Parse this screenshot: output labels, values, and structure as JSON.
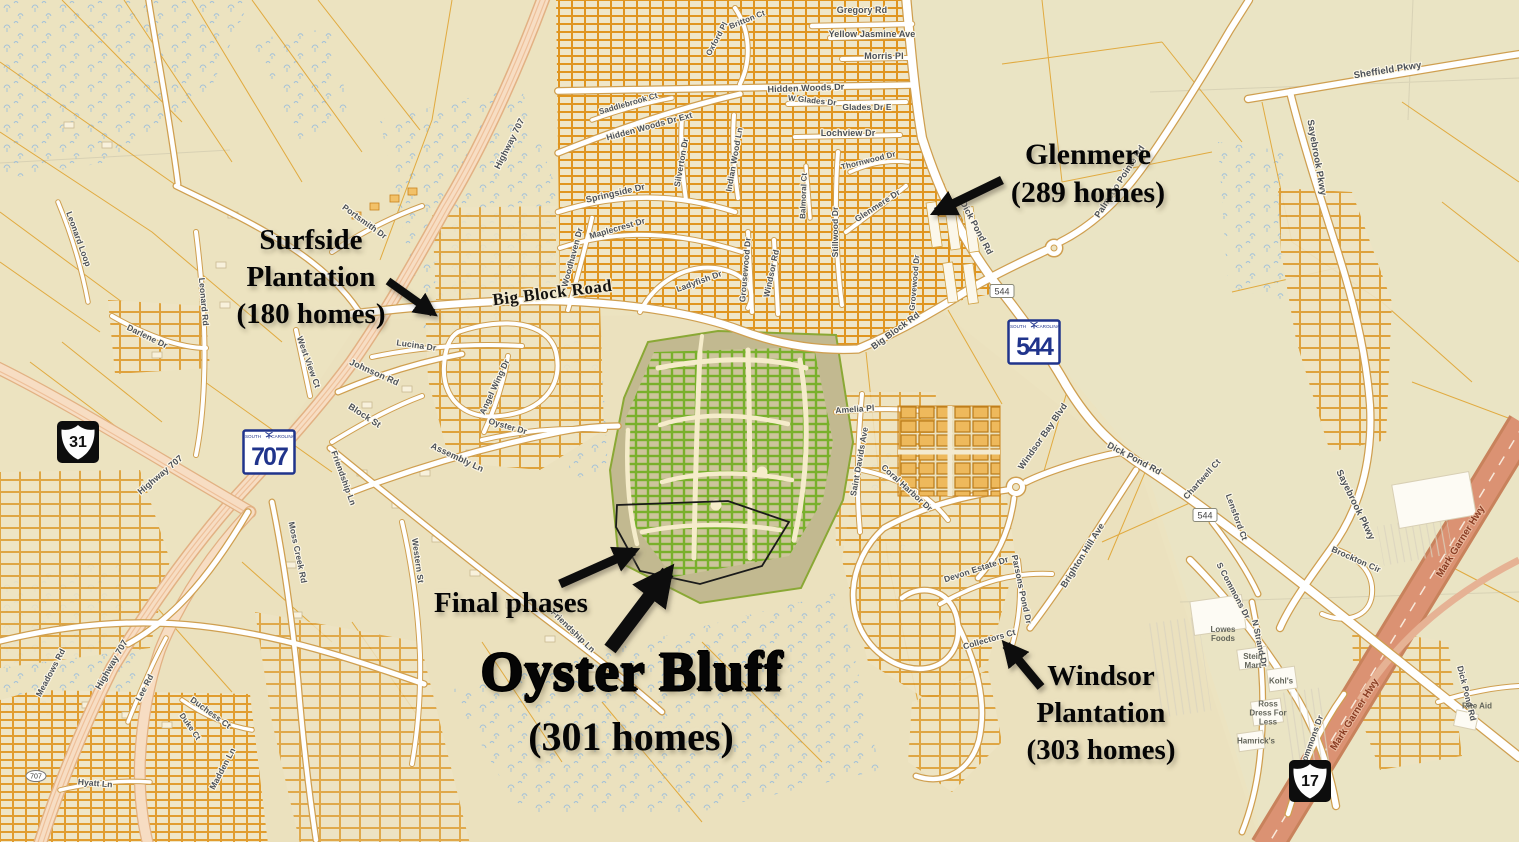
{
  "map_title": "Oyster Bluff area annotated map",
  "annotations": [
    {
      "id": "surfside-plantation",
      "lines": [
        "Surfside",
        "Plantation",
        "(180 homes)"
      ],
      "x": 311,
      "y": 222,
      "size": 29,
      "line_height": 37
    },
    {
      "id": "glenmere",
      "lines": [
        "Glenmere",
        "(289 homes)"
      ],
      "x": 1088,
      "y": 136,
      "size": 30,
      "line_height": 38
    },
    {
      "id": "final-phases",
      "lines": [
        "Final phases"
      ],
      "x": 511,
      "y": 586,
      "size": 29,
      "line_height": 34
    },
    {
      "id": "oyster-bluff",
      "lines": [
        "Oyster Bluff"
      ],
      "x": 632,
      "y": 641,
      "size": 55,
      "line_height": 62,
      "heavy": true
    },
    {
      "id": "oyster-bluff-homes",
      "lines": [
        "(301 homes)"
      ],
      "x": 631,
      "y": 714,
      "size": 40,
      "line_height": 46
    },
    {
      "id": "windsor-plantation",
      "lines": [
        "Windsor",
        "Plantation",
        "(303 homes)"
      ],
      "x": 1101,
      "y": 658,
      "size": 29,
      "line_height": 37
    }
  ],
  "arrows": [
    {
      "x1": 388,
      "y1": 281,
      "x2": 433,
      "y2": 313,
      "w": 8
    },
    {
      "x1": 1002,
      "y1": 180,
      "x2": 936,
      "y2": 212,
      "w": 9
    },
    {
      "x1": 560,
      "y1": 584,
      "x2": 634,
      "y2": 551,
      "w": 9
    },
    {
      "x1": 610,
      "y1": 649,
      "x2": 668,
      "y2": 572,
      "w": 14
    },
    {
      "x1": 1041,
      "y1": 687,
      "x2": 1006,
      "y2": 645,
      "w": 9
    }
  ],
  "shield_header": {
    "left": "SOUTH",
    "right": "CAROLINA"
  },
  "highway_shields": [
    {
      "type": "us",
      "label": "31",
      "x": 78,
      "y": 442
    },
    {
      "type": "sc",
      "label": "707",
      "x": 269,
      "y": 452
    },
    {
      "type": "sc",
      "label": "544",
      "x": 1034,
      "y": 342
    },
    {
      "type": "us",
      "label": "17",
      "x": 1310,
      "y": 781
    },
    {
      "type": "mini",
      "label": "544",
      "x": 1002,
      "y": 291
    },
    {
      "type": "mini",
      "label": "544",
      "x": 1205,
      "y": 515
    },
    {
      "type": "oval",
      "label": "707",
      "x": 36,
      "y": 776
    }
  ],
  "place_labels": [
    {
      "t": "Lowes\nFoods",
      "x": 1223,
      "y": 634
    },
    {
      "t": "Stein\nMart",
      "x": 1253,
      "y": 661
    },
    {
      "t": "Kohl's",
      "x": 1281,
      "y": 681
    },
    {
      "t": "Ross\nDress For\nLess",
      "x": 1268,
      "y": 713
    },
    {
      "t": "Hamrick's",
      "x": 1256,
      "y": 741
    },
    {
      "t": "Rite Aid",
      "x": 1477,
      "y": 706
    }
  ],
  "road_labels": [
    {
      "t": "Gregory Rd",
      "x": 862,
      "y": 13,
      "r": 0
    },
    {
      "t": "Yellow Jasmine Ave",
      "x": 872,
      "y": 37,
      "r": 0
    },
    {
      "t": "Morris Pl",
      "x": 884,
      "y": 59,
      "r": 0
    },
    {
      "t": "Hidden Woods Dr",
      "x": 806,
      "y": 91,
      "r": -2
    },
    {
      "t": "W Glades Dr",
      "x": 812,
      "y": 103,
      "r": 6,
      "s": 8
    },
    {
      "t": "Glades Dr E",
      "x": 867,
      "y": 110,
      "r": 0,
      "s": 8.5
    },
    {
      "t": "Lochview Dr",
      "x": 848,
      "y": 136,
      "r": 0
    },
    {
      "t": "Saddlebrook Ct",
      "x": 629,
      "y": 106,
      "r": -16,
      "s": 8
    },
    {
      "t": "Hidden Woods Dr Ext",
      "x": 650,
      "y": 129,
      "r": -15,
      "s": 8.5
    },
    {
      "t": "Oxford Pl",
      "x": 719,
      "y": 40,
      "r": -62,
      "s": 8
    },
    {
      "t": "Britton Ct",
      "x": 748,
      "y": 22,
      "r": -22,
      "s": 8
    },
    {
      "t": "Springside Dr",
      "x": 616,
      "y": 196,
      "r": -13
    },
    {
      "t": "Maplecrest Dr",
      "x": 618,
      "y": 231,
      "r": -16,
      "s": 8.5
    },
    {
      "t": "Woodhaven Dr",
      "x": 575,
      "y": 258,
      "r": -75,
      "s": 8.5
    },
    {
      "t": "Silverton Dr",
      "x": 684,
      "y": 163,
      "r": -80,
      "s": 8.5
    },
    {
      "t": "Indian Wood Ln",
      "x": 737,
      "y": 160,
      "r": -80,
      "s": 8.5
    },
    {
      "t": "Ladyfish Dr",
      "x": 700,
      "y": 284,
      "r": -20,
      "s": 8.5
    },
    {
      "t": "Grousewood Dr",
      "x": 748,
      "y": 270,
      "r": -85,
      "s": 8.5
    },
    {
      "t": "Windsor Rd",
      "x": 774,
      "y": 274,
      "r": -78,
      "s": 8.5
    },
    {
      "t": "Balmoral Ct",
      "x": 806,
      "y": 196,
      "r": -88,
      "s": 8
    },
    {
      "t": "Stillwood Dr",
      "x": 838,
      "y": 232,
      "r": -90,
      "s": 8.5
    },
    {
      "t": "Glenmere Dr",
      "x": 879,
      "y": 208,
      "r": -33,
      "s": 8.5
    },
    {
      "t": "Thornwood Dr",
      "x": 869,
      "y": 163,
      "r": -14,
      "s": 8
    },
    {
      "t": "Grovewood Dr",
      "x": 917,
      "y": 283,
      "r": -85,
      "s": 8
    },
    {
      "t": "Dick Pond Rd",
      "x": 974,
      "y": 229,
      "r": 62
    },
    {
      "t": "Big Block Road",
      "x": 553,
      "y": 298,
      "r": -7,
      "c": "rd-big"
    },
    {
      "t": "Big Block Rd",
      "x": 897,
      "y": 333,
      "r": -36
    },
    {
      "t": "Palmetto Pointe Rd",
      "x": 1122,
      "y": 183,
      "r": -57
    },
    {
      "t": "Sheffield Pkwy",
      "x": 1388,
      "y": 73,
      "r": -9,
      "s": 9.5
    },
    {
      "t": "Sayebrook Pkwy",
      "x": 1314,
      "y": 158,
      "r": 80,
      "s": 9.5
    },
    {
      "t": "Sayebrook Pkwy",
      "x": 1353,
      "y": 506,
      "r": 64,
      "s": 9.5
    },
    {
      "t": "Amelia Pl",
      "x": 855,
      "y": 412,
      "r": -4,
      "s": 8.5
    },
    {
      "t": "Saint Davids Ave",
      "x": 862,
      "y": 462,
      "r": -80,
      "s": 8.5
    },
    {
      "t": "Coral Harbor Dr",
      "x": 905,
      "y": 490,
      "r": 42,
      "s": 8.5
    },
    {
      "t": "Windsor Bay Blvd",
      "x": 1045,
      "y": 438,
      "r": -55
    },
    {
      "t": "Dick Pond Rd",
      "x": 1133,
      "y": 461,
      "r": 28
    },
    {
      "t": "Brighton Hill Ave",
      "x": 1085,
      "y": 557,
      "r": -58
    },
    {
      "t": "Devon Estate Dr",
      "x": 977,
      "y": 572,
      "r": -18,
      "s": 8.5
    },
    {
      "t": "Parsons Pond Dr",
      "x": 1019,
      "y": 590,
      "r": 78,
      "s": 8.5
    },
    {
      "t": "Collectors Ct",
      "x": 990,
      "y": 642,
      "r": -16,
      "s": 8.5
    },
    {
      "t": "Chartwell Ct",
      "x": 1204,
      "y": 481,
      "r": -48,
      "s": 8.5
    },
    {
      "t": "Lensford Ct",
      "x": 1234,
      "y": 518,
      "r": 70,
      "s": 8.5
    },
    {
      "t": "Brockton Cir",
      "x": 1355,
      "y": 562,
      "r": 24,
      "s": 8.5
    },
    {
      "t": "S Commons Dr",
      "x": 1231,
      "y": 592,
      "r": 62,
      "s": 8.5
    },
    {
      "t": "N Strand Dr",
      "x": 1257,
      "y": 644,
      "r": 78,
      "s": 8.5
    },
    {
      "t": "Commons Dr",
      "x": 1314,
      "y": 742,
      "r": -70,
      "s": 8.5
    },
    {
      "t": "Mark Garner Hwy",
      "x": 1463,
      "y": 543,
      "r": -58,
      "c": "hwy",
      "s": 10
    },
    {
      "t": "Mark Garner Hwy",
      "x": 1357,
      "y": 716,
      "r": -58,
      "c": "hwy",
      "s": 10
    },
    {
      "t": "Dick Pond Rd",
      "x": 1464,
      "y": 694,
      "r": 76,
      "s": 8.5
    },
    {
      "t": "Highway 707",
      "x": 162,
      "y": 477,
      "r": -40
    },
    {
      "t": "Highway 707",
      "x": 114,
      "y": 666,
      "r": -60
    },
    {
      "t": "Highway 707",
      "x": 512,
      "y": 145,
      "r": -63
    },
    {
      "t": "Johnson Rd",
      "x": 373,
      "y": 375,
      "r": 24
    },
    {
      "t": "Block St",
      "x": 363,
      "y": 418,
      "r": 33
    },
    {
      "t": "Assembly Ln",
      "x": 456,
      "y": 460,
      "r": 25
    },
    {
      "t": "Angel Wing Dr",
      "x": 497,
      "y": 388,
      "r": -65,
      "s": 8.5
    },
    {
      "t": "Oyster Dr",
      "x": 507,
      "y": 429,
      "r": 16,
      "s": 8.5
    },
    {
      "t": "Lucina Dr",
      "x": 416,
      "y": 348,
      "r": 8,
      "s": 8.5
    },
    {
      "t": "West View Ct",
      "x": 306,
      "y": 363,
      "r": 70,
      "s": 8.5
    },
    {
      "t": "Leonard Rd",
      "x": 201,
      "y": 302,
      "r": 85,
      "s": 8.5
    },
    {
      "t": "Leonard Loop",
      "x": 76,
      "y": 240,
      "r": 70,
      "s": 8.5
    },
    {
      "t": "Darlene Dr",
      "x": 146,
      "y": 339,
      "r": 26,
      "s": 8.5
    },
    {
      "t": "Portsmith Dr",
      "x": 363,
      "y": 224,
      "r": 36,
      "s": 8.5
    },
    {
      "t": "Friendship Ln",
      "x": 341,
      "y": 479,
      "r": 70,
      "s": 8.5
    },
    {
      "t": "Friendship Ln",
      "x": 571,
      "y": 633,
      "r": 44,
      "s": 8.5
    },
    {
      "t": "Moss Creek Rd",
      "x": 295,
      "y": 553,
      "r": 78,
      "s": 8.5
    },
    {
      "t": "Western St",
      "x": 415,
      "y": 561,
      "r": 82,
      "s": 8.5
    },
    {
      "t": "Lee Rd",
      "x": 147,
      "y": 689,
      "r": -62,
      "s": 8.5
    },
    {
      "t": "Duchess Ct",
      "x": 209,
      "y": 715,
      "r": 36,
      "s": 8.5
    },
    {
      "t": "Duke Ct",
      "x": 188,
      "y": 728,
      "r": 55,
      "s": 8
    },
    {
      "t": "Madden Ln",
      "x": 225,
      "y": 770,
      "r": -62,
      "s": 8.5
    },
    {
      "t": "Meadows Rd",
      "x": 53,
      "y": 674,
      "r": -62,
      "s": 8.5
    },
    {
      "t": "Hyatt Ln",
      "x": 95,
      "y": 786,
      "r": 5,
      "s": 8.5
    }
  ],
  "colors": {
    "background_tan": "#ece3c0",
    "parcel_orange": "#dfa028",
    "road_casing": "#cf9f50",
    "road_fill": "#ffffff",
    "corridor_pink": "#f7ddc3",
    "freeway_salmon": "#db9273",
    "wetland_blue": "#8fb8e0",
    "development_green": "#79b02c",
    "development_fill": "#c2b990",
    "annotation_black": "#050505",
    "shield_blue": "#20348c"
  }
}
